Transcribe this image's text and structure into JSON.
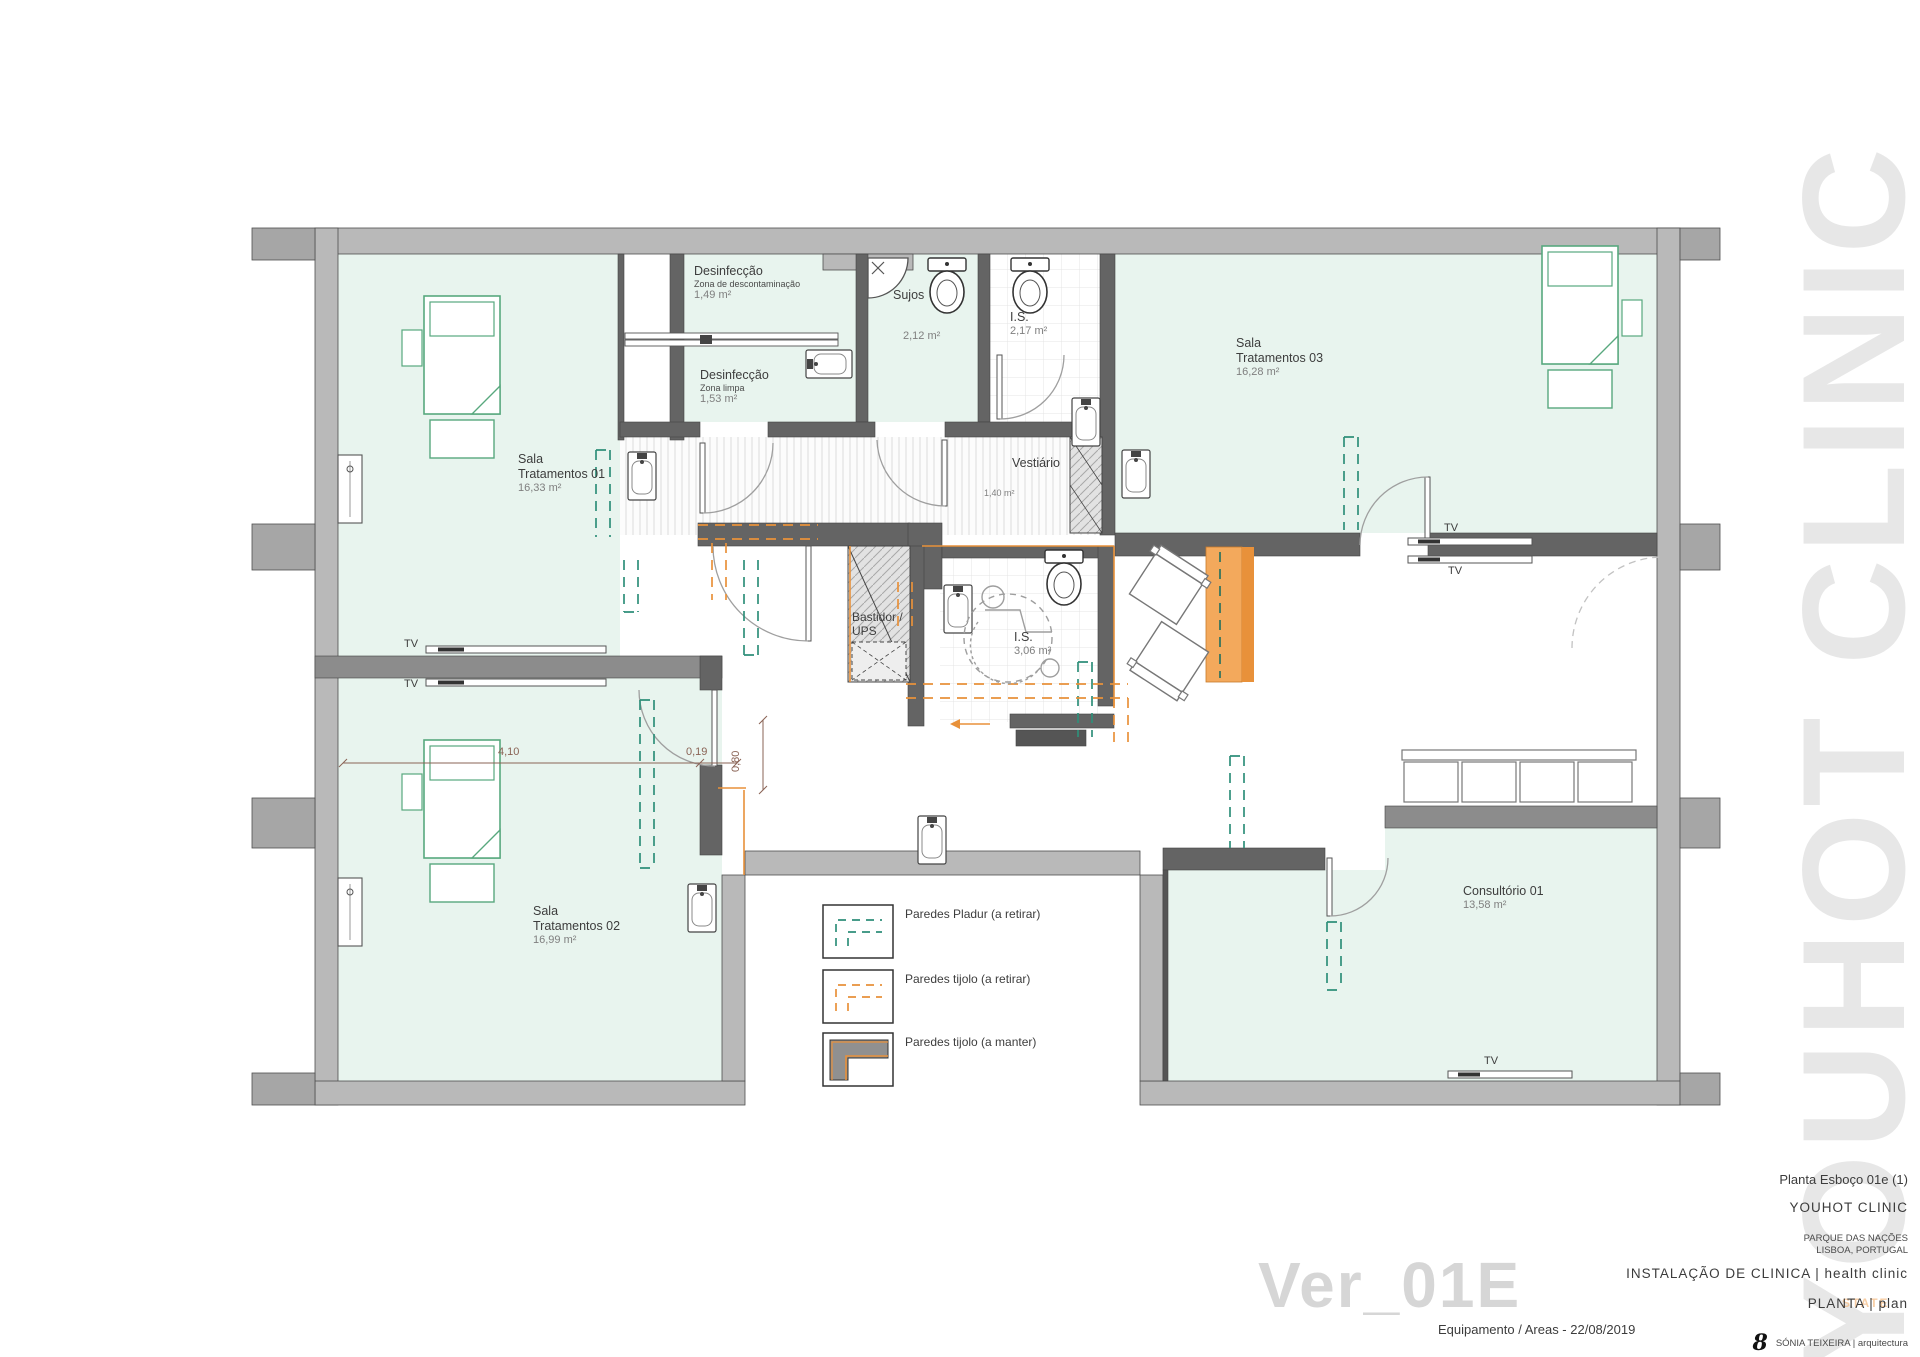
{
  "rooms": {
    "sala01": {
      "line1": "Sala",
      "line2": "Tratamentos 01",
      "area": "16,33 m²"
    },
    "sala02": {
      "line1": "Sala",
      "line2": "Tratamentos 02",
      "area": "16,99 m²"
    },
    "sala03": {
      "line1": "Sala",
      "line2": "Tratamentos 03",
      "area": "16,28 m²"
    },
    "consultorio": {
      "line1": "Consultório 01",
      "area": "13,58 m²"
    },
    "desinf_top": {
      "line1": "Desinfecção",
      "line2": "Zona de descontaminação",
      "area": "1,49 m²"
    },
    "desinf_bottom": {
      "line1": "Desinfecção",
      "line2": "Zona limpa",
      "area": "1,53 m²"
    },
    "sujos": {
      "line1": "Sujos",
      "area": "2,12 m²"
    },
    "is_small": {
      "line1": "I.S.",
      "area": "2,17 m²"
    },
    "is_large": {
      "line1": "I.S.",
      "area": "3,06 m²"
    },
    "vestiario": {
      "line1": "Vestiário",
      "area": "1,40 m²"
    },
    "bastidor": {
      "line1": "Bastidor /",
      "line2": "UPS"
    }
  },
  "labels": {
    "tv": "TV"
  },
  "dimensions": {
    "d_main": "4,10",
    "d_small": "0,19",
    "d_vert": "0,80"
  },
  "legend": {
    "items": [
      {
        "label": "Paredes Pladur (a retirar)",
        "color": "#2f8f7a"
      },
      {
        "label": "Paredes tijolo (a retirar)",
        "color": "#e8913a"
      },
      {
        "label": "Paredes tijolo (a manter)",
        "color": "#8a8a8a"
      }
    ]
  },
  "title_block": {
    "sheet": "Planta Esboço 01e (1)",
    "client": "YOUHOT CLINIC",
    "location_line1": "PARQUE DAS NAÇÕES",
    "location_line2": "LISBOA, PORTUGAL",
    "project": "INSTALAÇÃO DE CLINICA | health clinic",
    "drawing": "PLANTA | plan",
    "phase": "Equipamento / Areas - 22/08/2019",
    "architect": "SÓNIA TEIXEIRA | arquitectura",
    "logo_glyph": "8"
  },
  "watermarks": {
    "vertical": "YOUHOT CLINIC",
    "version": "Ver_01E",
    "fragment": "STATE"
  },
  "colors": {
    "room_mint": "#e8f4ee",
    "wall_exterior": "#b9b9b9",
    "wall_interior": "#646464",
    "teal_dashed": "#2f8f7a",
    "orange_dashed": "#e8913a",
    "orange_fill": "#f3a95c",
    "bed_green": "#58a87e",
    "dimension": "#8a6355"
  }
}
